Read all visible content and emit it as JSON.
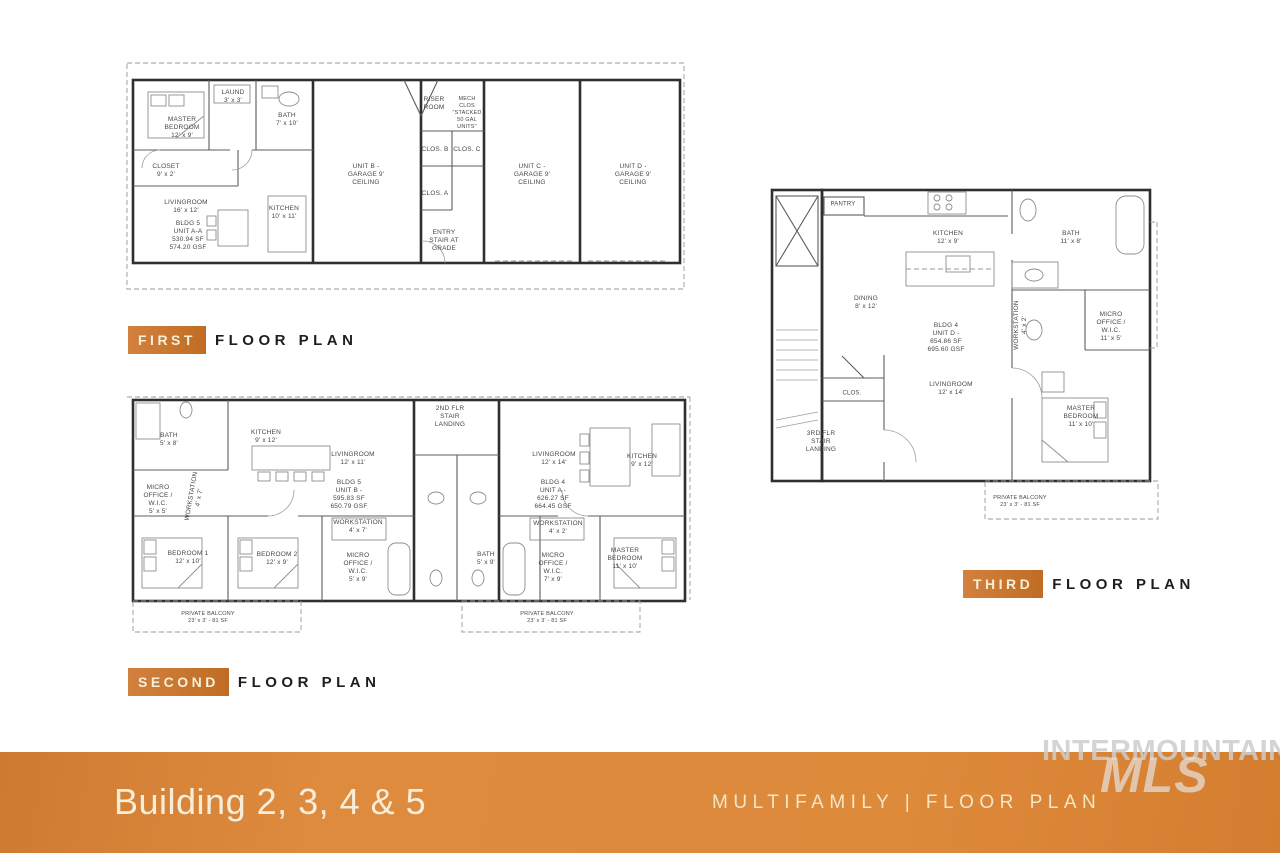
{
  "plan_labels": {
    "first": {
      "tag": "FIRST",
      "rest": "FLOOR PLAN"
    },
    "second": {
      "tag": "SECOND",
      "rest": "FLOOR PLAN"
    },
    "third": {
      "tag": "THIRD",
      "rest": "FLOOR PLAN"
    }
  },
  "banner": {
    "title": "Building 2, 3, 4 & 5",
    "subtitle": "MULTIFAMILY | FLOOR PLAN"
  },
  "watermark": {
    "line1": "INTERMOUNTAIN",
    "line2": "MLS"
  },
  "colors": {
    "accent_orange": "#C06C24",
    "banner_orange": "#DE8B3E",
    "heading_text": "#1E1E1E",
    "plan_line": "#2F2F2F",
    "watermark_gray": "#CDCDCD"
  },
  "plans": {
    "first": {
      "title": "First floor plan",
      "rooms": [
        {
          "text": "MASTER\nBEDROOM\n12' x 9'",
          "x": 182,
          "y": 128
        },
        {
          "text": "LAUND\n3' x 3'",
          "x": 233,
          "y": 97
        },
        {
          "text": "BATH\n7' x 10'",
          "x": 287,
          "y": 120
        },
        {
          "text": "CLOSET\n9' x 2'",
          "x": 166,
          "y": 171
        },
        {
          "text": "LIVINGROOM\n16' x 12'",
          "x": 186,
          "y": 207
        },
        {
          "text": "BLDG 5\nUNIT A-A\n530.94 SF\n574.20 GSF",
          "x": 188,
          "y": 236
        },
        {
          "text": "KITCHEN\n10' x 11'",
          "x": 284,
          "y": 213
        },
        {
          "text": "UNIT B -\nGARAGE 9'\nCEILING",
          "x": 366,
          "y": 175
        },
        {
          "text": "RISER\nROOM",
          "x": 434,
          "y": 104
        },
        {
          "text": "MECH\nCLOS\n\"STACKED\n50 GAL\nUNITS\"",
          "x": 467,
          "y": 113,
          "size": 5.5
        },
        {
          "text": "CLOS. B",
          "x": 435,
          "y": 150
        },
        {
          "text": "CLOS. C",
          "x": 467,
          "y": 150
        },
        {
          "text": "CLOS. A",
          "x": 435,
          "y": 194
        },
        {
          "text": "ENTRY\nSTAIR AT\nGRADE",
          "x": 444,
          "y": 241
        },
        {
          "text": "UNIT C -\nGARAGE 9'\nCEILING",
          "x": 532,
          "y": 175
        },
        {
          "text": "UNIT D -\nGARAGE 9'\nCEILING",
          "x": 633,
          "y": 175
        }
      ]
    },
    "second": {
      "title": "Second floor plan",
      "rooms": [
        {
          "text": "BATH\n5' x 8'",
          "x": 169,
          "y": 440
        },
        {
          "text": "KITCHEN\n9' x 12'",
          "x": 266,
          "y": 437
        },
        {
          "text": "LIVINGROOM\n12' x 11'",
          "x": 353,
          "y": 459
        },
        {
          "text": "BLDG 5\nUNIT B -\n595.83 SF\n650.79 GSF",
          "x": 349,
          "y": 495
        },
        {
          "text": "MICRO\nOFFICE /\nW.I.C.\n5' x 5'",
          "x": 158,
          "y": 500
        },
        {
          "text": "WORKSTATION\n4' x 7'",
          "x": 196,
          "y": 497,
          "rot": -80
        },
        {
          "text": "BEDROOM 1\n12' x 10'",
          "x": 188,
          "y": 558
        },
        {
          "text": "BEDROOM 2\n12' x 9'",
          "x": 277,
          "y": 559
        },
        {
          "text": "WORKSTATION\n4' x 7'",
          "x": 358,
          "y": 527
        },
        {
          "text": "MICRO\nOFFICE /\nW.I.C.\n5' x 9'",
          "x": 358,
          "y": 568
        },
        {
          "text": "2ND FLR\nSTAIR\nLANDING",
          "x": 450,
          "y": 417
        },
        {
          "text": "LIVINGROOM\n12' x 14'",
          "x": 554,
          "y": 459
        },
        {
          "text": "BLDG 4\nUNIT A -\n626.27 SF\n664.45 GSF",
          "x": 553,
          "y": 495
        },
        {
          "text": "KITCHEN\n9' x 12'",
          "x": 642,
          "y": 461
        },
        {
          "text": "WORKSTATION\n4' x 2'",
          "x": 558,
          "y": 528
        },
        {
          "text": "BATH\n5' x 9'",
          "x": 486,
          "y": 559
        },
        {
          "text": "MICRO\nOFFICE /\nW.I.C.\n7' x 9'",
          "x": 553,
          "y": 568
        },
        {
          "text": "MASTER\nBEDROOM\n11' x 10'",
          "x": 625,
          "y": 559
        },
        {
          "text": "PRIVATE BALCONY\n23' x 3' - 81 SF",
          "x": 208,
          "y": 618,
          "size": 5.5
        },
        {
          "text": "PRIVATE BALCONY\n23' x 3' - 81 SF",
          "x": 547,
          "y": 618,
          "size": 5.5
        }
      ]
    },
    "third": {
      "title": "Third floor plan",
      "rooms": [
        {
          "text": "PANTRY",
          "x": 843,
          "y": 205,
          "size": 6
        },
        {
          "text": "KITCHEN\n12' x 9'",
          "x": 948,
          "y": 238
        },
        {
          "text": "DINING\n8' x 12'",
          "x": 866,
          "y": 303
        },
        {
          "text": "BLDG 4\nUNIT D -\n654.86 SF\n695.60 GSF",
          "x": 946,
          "y": 338
        },
        {
          "text": "BATH\n11' x 8'",
          "x": 1071,
          "y": 238
        },
        {
          "text": "WORKSTATION\n4' x 2'",
          "x": 1021,
          "y": 325,
          "rot": -90
        },
        {
          "text": "MICRO\nOFFICE /\nW.I.C.\n11' x 5'",
          "x": 1111,
          "y": 327
        },
        {
          "text": "CLOS.",
          "x": 852,
          "y": 394,
          "size": 6
        },
        {
          "text": "3RD FLR\nSTAIR\nLANDING",
          "x": 821,
          "y": 442
        },
        {
          "text": "LIVINGROOM\n12' x 14'",
          "x": 951,
          "y": 389
        },
        {
          "text": "MASTER\nBEDROOM\n11' x 10'",
          "x": 1081,
          "y": 417
        },
        {
          "text": "PRIVATE BALCONY\n23' x 3' - 81 SF",
          "x": 1020,
          "y": 502,
          "size": 5.5
        }
      ]
    }
  }
}
